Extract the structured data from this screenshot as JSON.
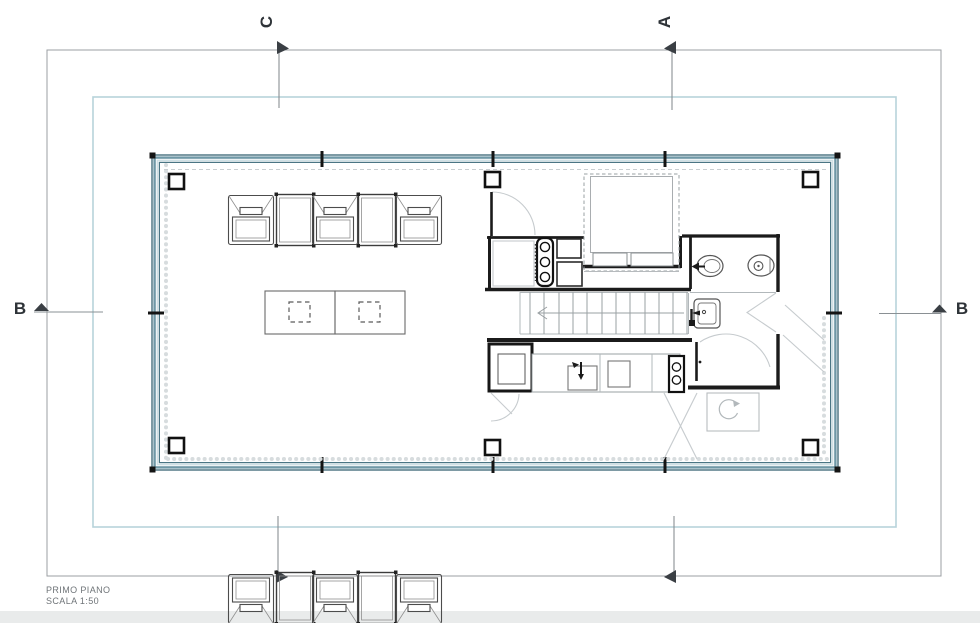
{
  "drawing": {
    "section_markers": {
      "top": "C",
      "top_right": "A",
      "left": "B",
      "right": "B"
    },
    "title": {
      "line1": "PRIMO PIANO",
      "line2": "SCALA 1:50"
    }
  },
  "colors": {
    "wall_accent_teal": "#7fa7b3",
    "wall_edge_teal": "#466f7d",
    "frame_blue": "#b7d3da",
    "frame_gray": "#9b9fa3",
    "ink": "#2e3338",
    "interior_wall": "#1b1b1b"
  }
}
